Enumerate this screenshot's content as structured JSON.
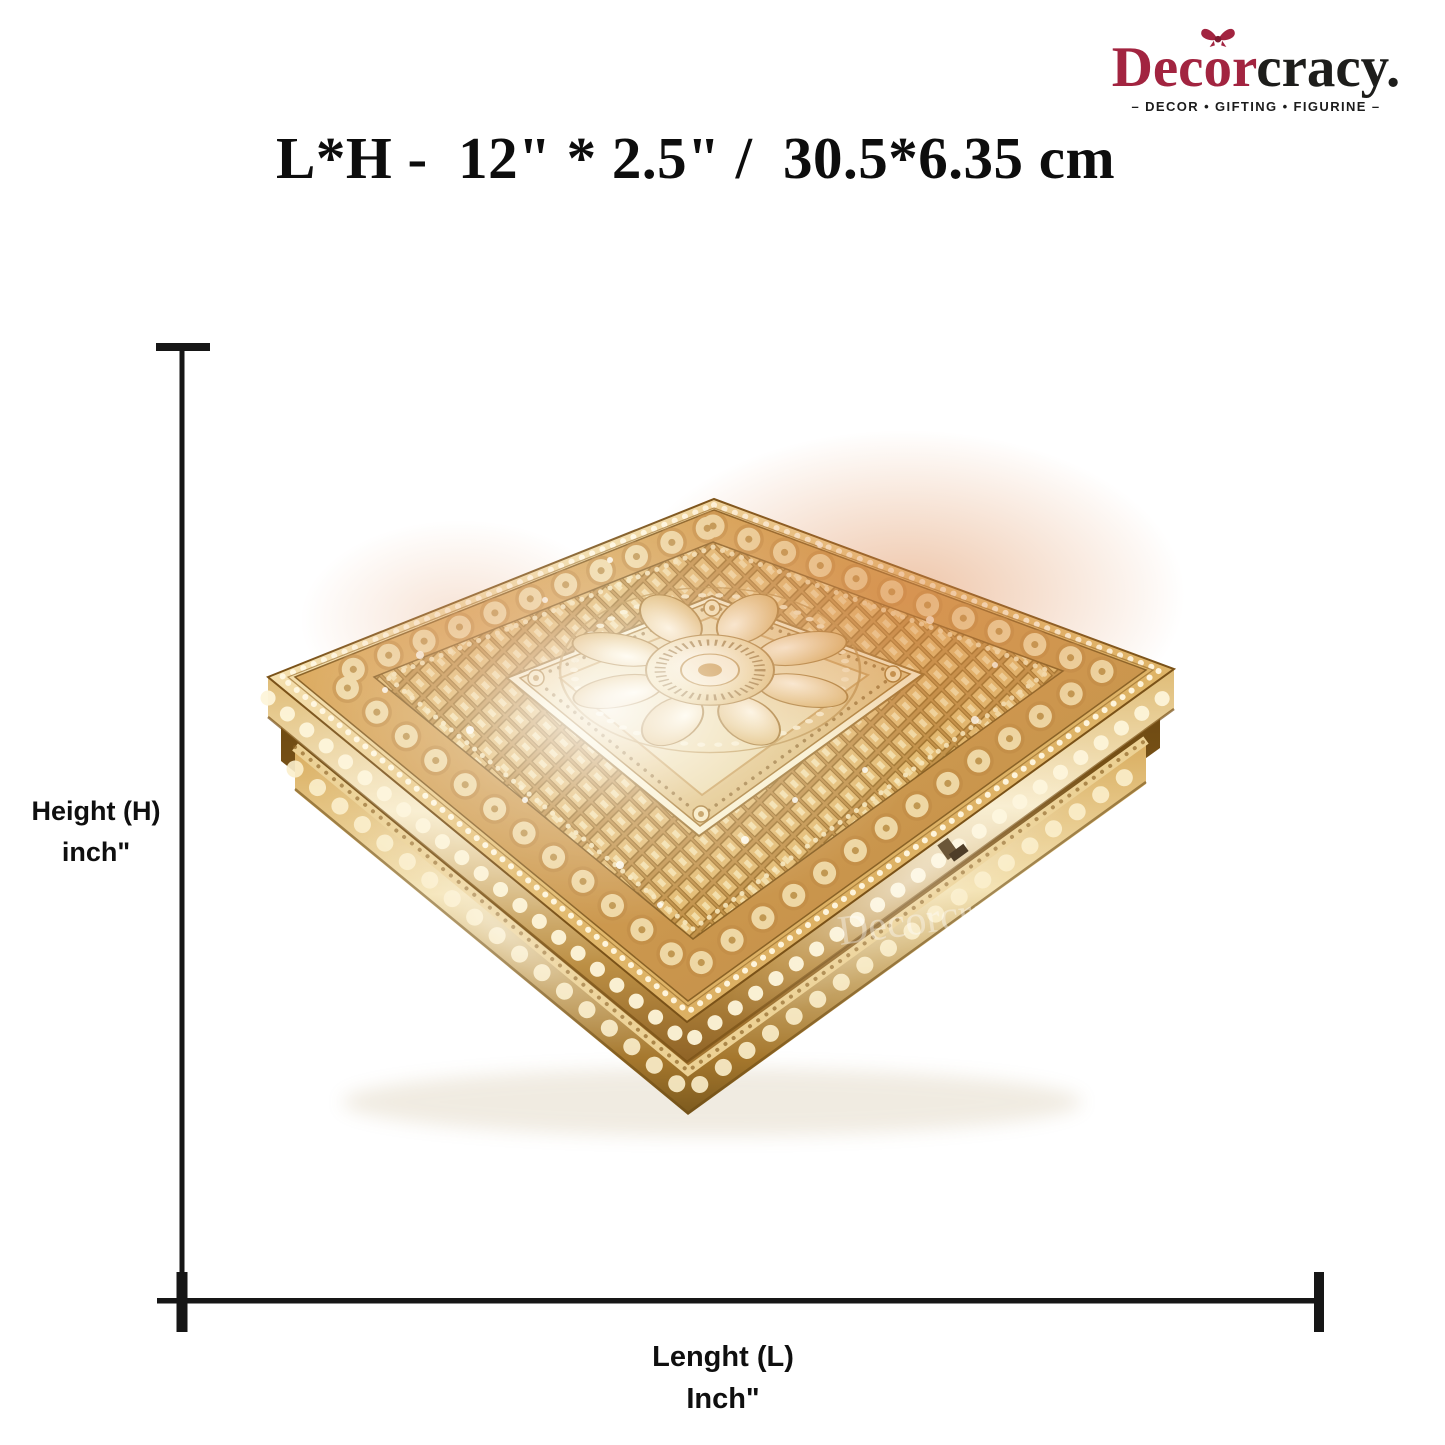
{
  "brand": {
    "logo": {
      "part_dec": "Dec",
      "part_o": "o",
      "part_r": "r",
      "part_rest": "cracy.",
      "tagline": "– DECOR • GIFTING • FIGURINE –",
      "color_red": "#a22440",
      "color_dark": "#1d1d1b"
    }
  },
  "dimensions": {
    "title": "L*H -  12\" * 2.5\" /  30.5*6.35 cm",
    "height_label": {
      "line1": "Height (H)",
      "line2": "inch\""
    },
    "length_label": {
      "line1": "Lenght (L)",
      "line2": "Inch\""
    },
    "line_color": "#161616"
  },
  "product": {
    "watermark": "Decorcracy",
    "colors": {
      "gold_primary": "#d5a558",
      "gold_highlight": "#fdf6dd",
      "gold_deep": "#8a5e22",
      "copper_tint": "#dd8a50"
    }
  }
}
